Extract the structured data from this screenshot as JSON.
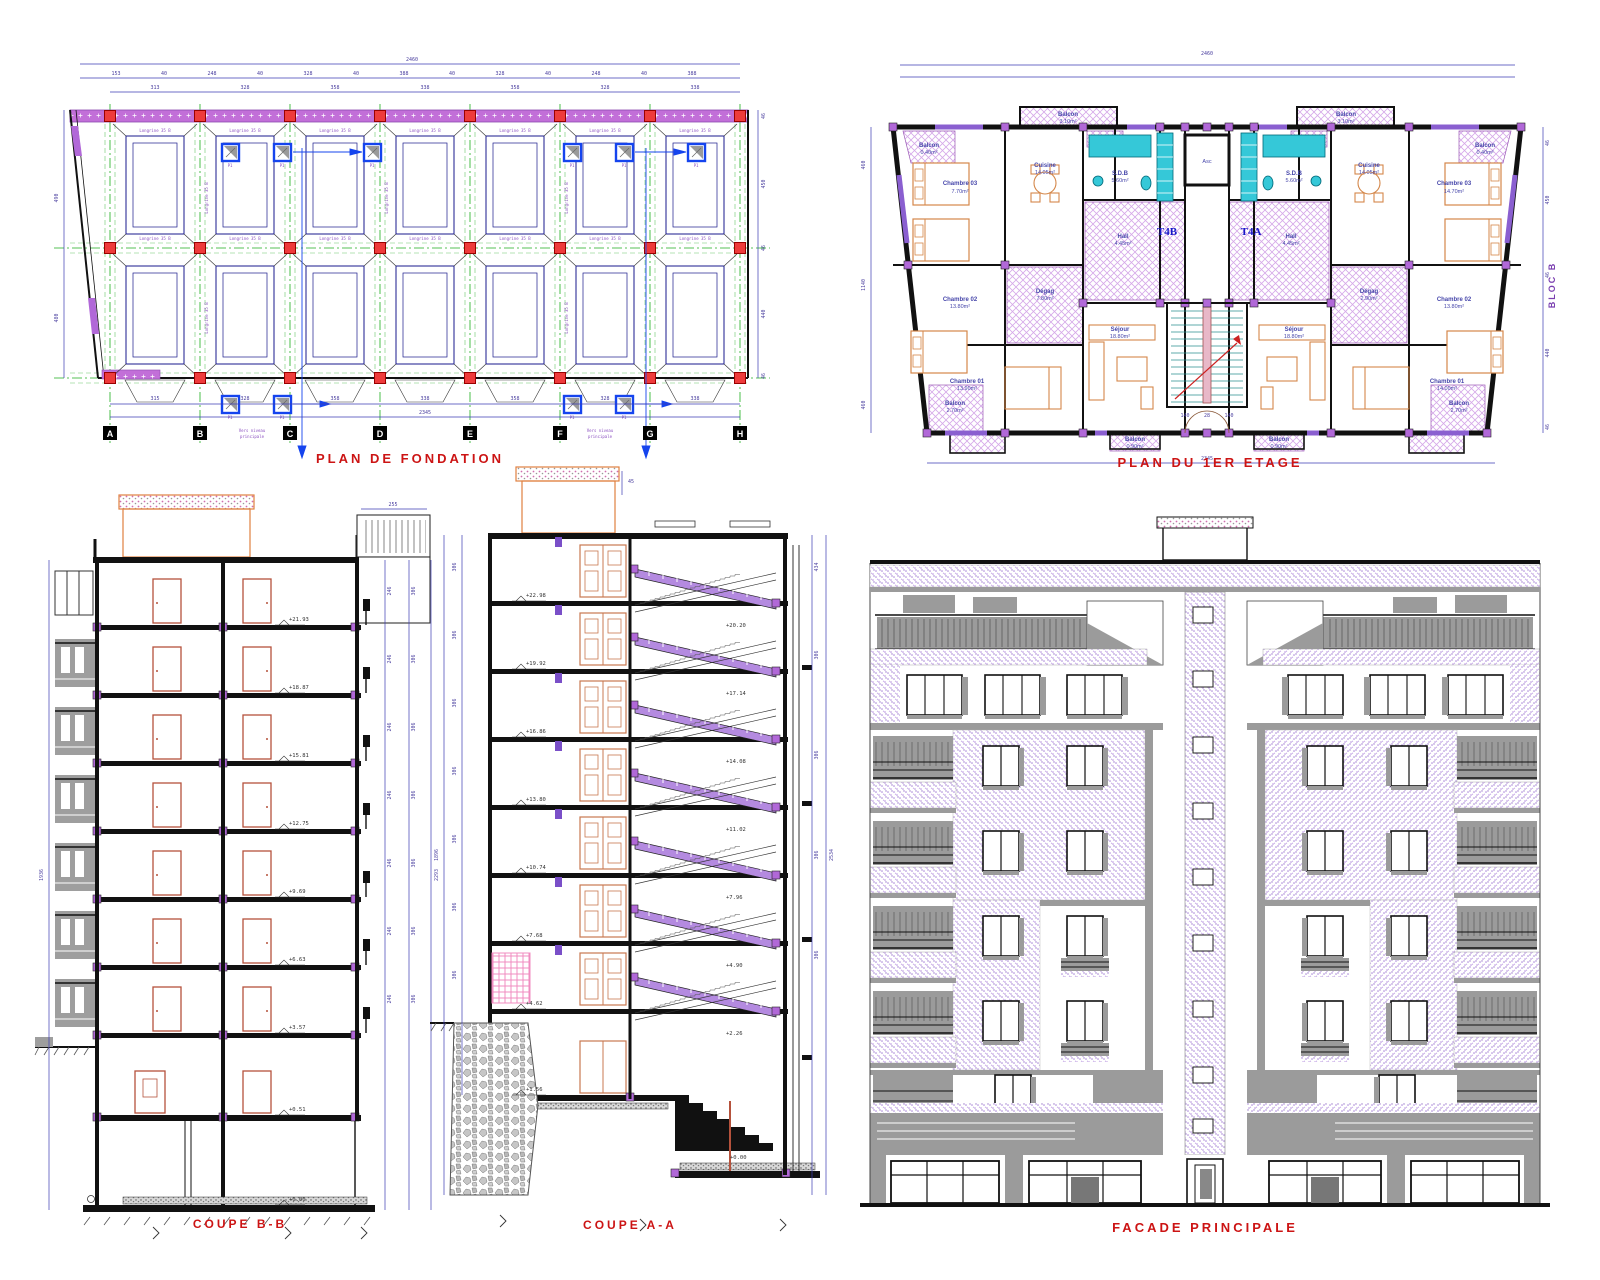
{
  "sheet": {
    "background": "#ffffff"
  },
  "colors": {
    "title_red": "#cc1414",
    "dim_blue": "#3c3cb4",
    "axis_green": "#1faf1f",
    "wall_black": "#111111",
    "footing_navy": "#1a1a8c",
    "column_red": "#ee3b3b",
    "node_purple": "#b168d8",
    "band_purple": "#c26fd8",
    "tile_lavender": "#d5a8e8",
    "fixture_cyan": "#35c8d8",
    "furniture_orange": "#d4874a",
    "stair_purple": "#b48ae0",
    "facade_stipple": "#a884d8",
    "shadow_gray": "#9b9b9b",
    "door_brown": "#b5523c",
    "pier_blue": "#1544ee"
  },
  "titles": {
    "fondation": "PLAN DE FONDATION",
    "etage": "PLAN DU 1ER ETAGE",
    "coupe_bb": "COUPE B-B",
    "coupe_aa": "COUPE A-A",
    "facade": "FACADE PRINCIPALE"
  },
  "fondation": {
    "total_top": "2460",
    "total_bottom": "2345",
    "chain_top": [
      "153",
      "40",
      "248",
      "40",
      "328",
      "40",
      "388",
      "40",
      "328",
      "40",
      "248",
      "40",
      "388"
    ],
    "chain_axes": [
      "313",
      "328",
      "358",
      "338",
      "358",
      "328",
      "338"
    ],
    "chain_bottom": [
      "315",
      "328",
      "358",
      "338",
      "358",
      "328",
      "338"
    ],
    "left_dims": [
      "490",
      "480"
    ],
    "right_dims": [
      "46",
      "450",
      "46",
      "440",
      "46"
    ],
    "grid_letters": [
      "A",
      "B",
      "C",
      "D",
      "E",
      "F",
      "G",
      "H"
    ],
    "beam_label": "Longrine 35 B",
    "pier_label": "P1",
    "note_line1": "Vers niveau",
    "note_line2": "principale"
  },
  "etage": {
    "t4b": "T4B",
    "t4a": "T4A",
    "bloc": "BLOC B",
    "asc": "Asc",
    "total_top": "2460",
    "total_bottom": "2345",
    "left_dims": [
      "460",
      "1140",
      "460"
    ],
    "right_dims": [
      "46",
      "450",
      "46",
      "440",
      "46"
    ],
    "stair_dims": [
      "140",
      "28",
      "140"
    ],
    "rooms": {
      "balcon_s": {
        "n": "Balcon",
        "a": "0.40m²"
      },
      "balcon_t": {
        "n": "Balcon",
        "a": "3.10m²"
      },
      "balcon_b": {
        "n": "Balcon",
        "a": "2.70m²"
      },
      "balcon_e": {
        "n": "Balcon",
        "a": "0.90m²"
      },
      "ch03_l": {
        "n": "Chambre 03",
        "a": "7.70m²"
      },
      "ch03_r": {
        "n": "Chambre 03",
        "a": "14.70m²"
      },
      "ch02": {
        "n": "Chambre 02",
        "a": "13.80m²"
      },
      "ch01_l": {
        "n": "Chambre 01",
        "a": "13.90m²"
      },
      "ch01_r": {
        "n": "Chambre 01",
        "a": "14.00m²"
      },
      "cuisine": {
        "n": "Cuisine",
        "a": "14.05m²"
      },
      "sdb": {
        "n": "S.D.B",
        "a": "5.60m²"
      },
      "hall": {
        "n": "Hall",
        "a": "4.45m²"
      },
      "degag_l": {
        "n": "Dégag",
        "a": "7.80m²"
      },
      "degag_r": {
        "n": "Dégag",
        "a": "2.90m²"
      },
      "sejour": {
        "n": "Séjour",
        "a": "18.80m²"
      }
    }
  },
  "coupe_bb": {
    "levels": [
      "+21.93",
      "+18.87",
      "+15.81",
      "+12.75",
      "+9.69",
      "+6.63",
      "+3.57",
      "+0.51",
      "+0.00"
    ],
    "dim_annex": "255",
    "storey_dim": "306",
    "room_dim": "246",
    "total_left": "1936",
    "total_right": "2293"
  },
  "coupe_aa": {
    "levels_left": [
      "+22.98",
      "+19.92",
      "+16.86",
      "+13.80",
      "+10.74",
      "+7.68",
      "+4.62",
      "+1.56"
    ],
    "levels_right": [
      "+20.20",
      "+17.14",
      "+14.08",
      "+11.02",
      "+7.96",
      "+4.90",
      "+2.26"
    ],
    "level_zero": "+0.00",
    "dim_roof": "45",
    "dim_top_right": "434",
    "storey_dim": "306",
    "total_left": "1896",
    "total_right": "2534"
  }
}
